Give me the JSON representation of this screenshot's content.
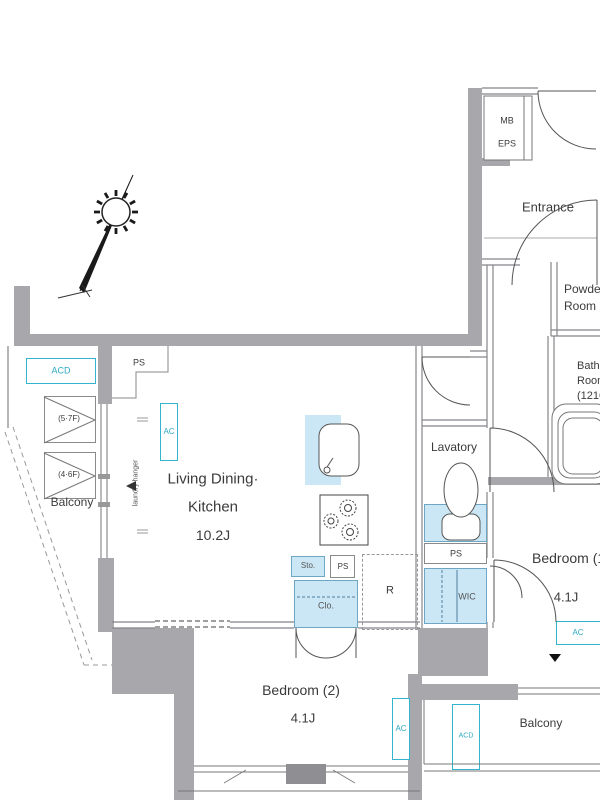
{
  "colors": {
    "wall_gray": "#a7a7ac",
    "wall_dark": "#8e8e93",
    "fixture_blue": "#cbe7f5",
    "blue_border": "#6ea7c4",
    "accent_cyan": "#35b4cf",
    "line": "#777777",
    "text": "#3b3b3b"
  },
  "labels": {
    "mb": "MB",
    "eps": "EPS",
    "entrance": "Entrance",
    "powder_line1": "Powder",
    "powder_line2": "Room",
    "bath_line1": "Bath",
    "bath_line2": "Room",
    "bath_line3": "(1216)",
    "lavatory": "Lavatory",
    "ldk_line1": "Living Dining·",
    "ldk_line2": "Kitchen",
    "ldk_size": "10.2J",
    "bedroom1": "Bedroom (1)",
    "bedroom1_size": "4.1J",
    "bedroom2": "Bedroom (2)",
    "bedroom2_size": "4.1J",
    "balcony": "Balcony",
    "wic": "WIC",
    "clo": "Clo.",
    "sto": "Sto.",
    "fridge": "R",
    "ps": "PS",
    "ac": "AC",
    "acd": "ACD",
    "floors_5_7": "(5·7F)",
    "floors_4_6": "(4·6F)",
    "laundry_hanger": "laundry hanger"
  }
}
